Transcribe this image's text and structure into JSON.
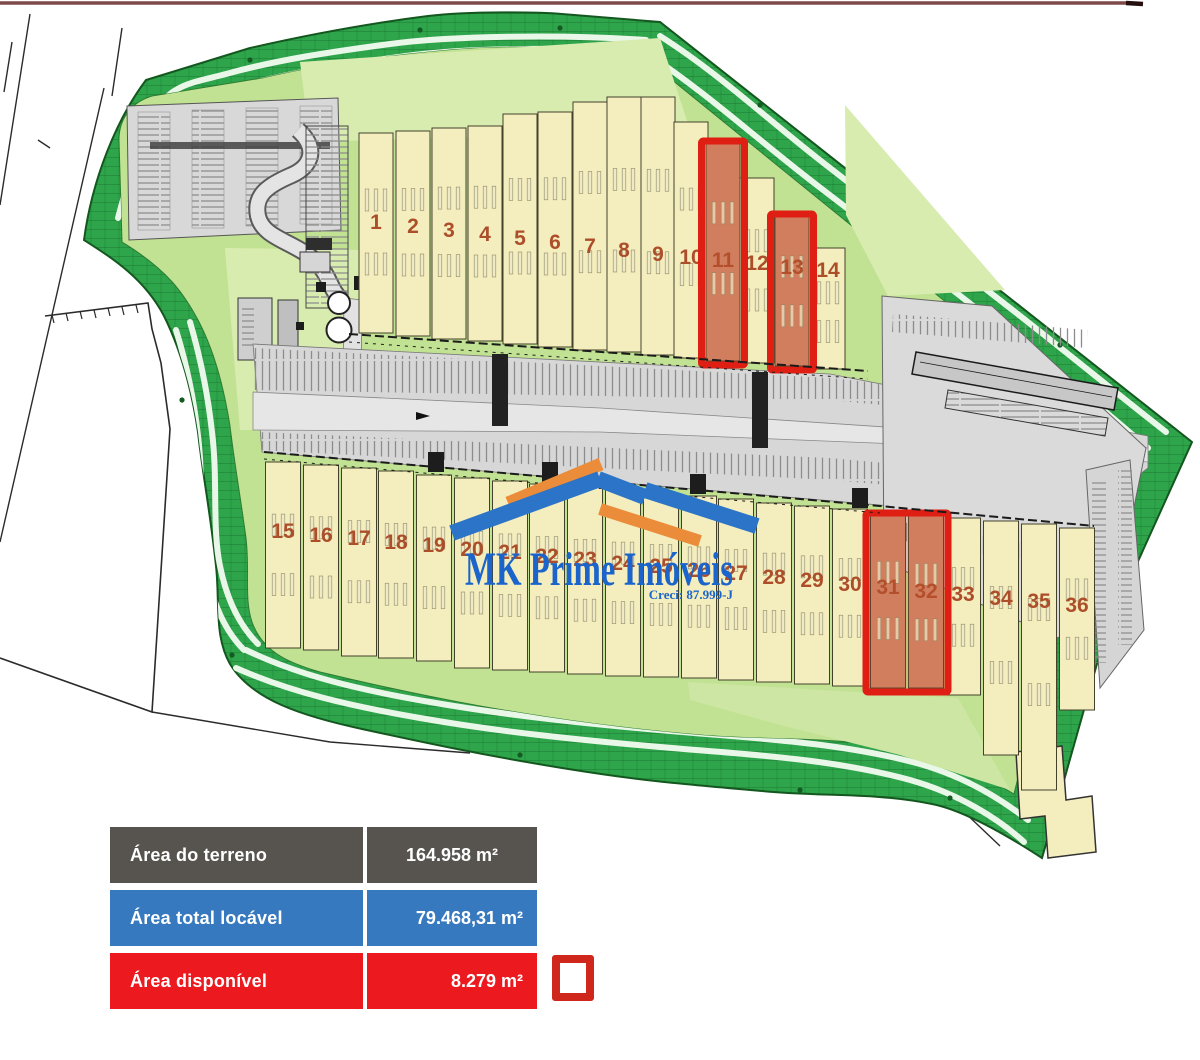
{
  "logo": {
    "title": "MK Prime Imóveis",
    "creci": "Creci: 87.999-J",
    "title_color": "#1A64CB",
    "roof_blue": "#2B74C8",
    "roof_orange": "#EB8C3B"
  },
  "legend": {
    "rows": [
      {
        "id": "terreno",
        "label": "Área do terreno",
        "value": "164.958 m²",
        "bg": "#575450"
      },
      {
        "id": "locavel",
        "label": "Área total locável",
        "value": "79.468,31 m²",
        "bg": "#3779BE"
      },
      {
        "id": "disponivel",
        "label": "Área disponível",
        "value": "8.279 m²",
        "bg": "#EC1A1F"
      }
    ],
    "swatch_border": "#CF271B"
  },
  "map": {
    "colors": {
      "unit_fill": "#F4EDBD",
      "unit_border": "#43412A",
      "number": "#AC4E2A",
      "highlight_fill": "#D28A6B",
      "highlight_tint": "rgba(205,85,50,0.22)",
      "highlight_border": "#E01F14",
      "band": "#2EA44B",
      "band_edge": "#14571F",
      "inner_green": "#C2E293",
      "pale_green": "#D9ECB0",
      "road": "#D7D7D7"
    },
    "rows": [
      {
        "name": "top",
        "labels": [
          "1",
          "2",
          "3",
          "4",
          "5",
          "6",
          "7",
          "8",
          "9",
          "10",
          "11",
          "12",
          "13",
          "14"
        ],
        "highlighted": [
          "11",
          "13"
        ]
      },
      {
        "name": "bottom",
        "labels": [
          "15",
          "16",
          "17",
          "18",
          "19",
          "20",
          "21",
          "22",
          "23",
          "24",
          "25",
          "26",
          "27",
          "28",
          "29",
          "30",
          "31",
          "32",
          "33",
          "34",
          "35",
          "36"
        ],
        "highlighted": [
          "31",
          "32"
        ]
      }
    ]
  }
}
